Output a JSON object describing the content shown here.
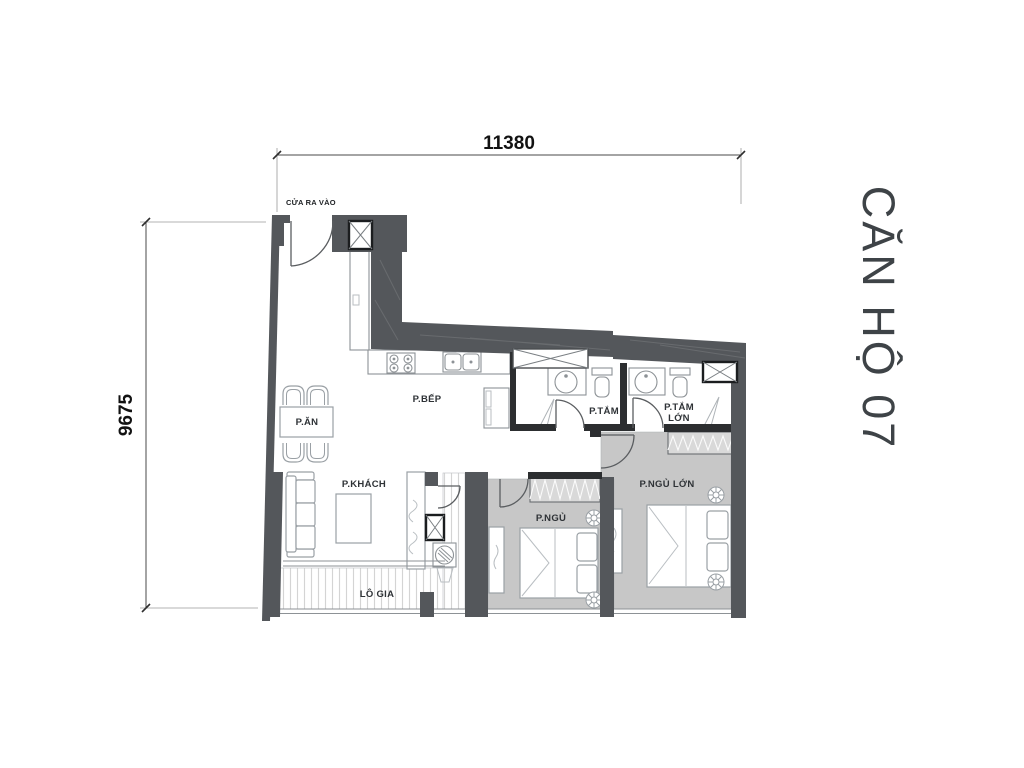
{
  "title": "CĂN HỘ 07",
  "dimensions": {
    "width": "11380",
    "height": "9675"
  },
  "labels": {
    "entrance": "CỬA RA VÀO",
    "dining": "P.ĂN",
    "kitchen": "P.BẾP",
    "living": "P.KHÁCH",
    "loggia": "LÔ GIA",
    "bathroom": "P.TẮM",
    "bathroom_large_1": "P.TẮM",
    "bathroom_large_2": "LỚN",
    "bedroom": "P.NGỦ",
    "bedroom_large": "P.NGỦ LỚN"
  },
  "colors": {
    "wall": "#54575b",
    "partition": "#2c2e30",
    "floor": "#c7c7c7",
    "wardrobe": "#d9d9d9",
    "outline": "#9aa0a5",
    "stripe": "#d4d4d4",
    "title": "#3e4347"
  }
}
